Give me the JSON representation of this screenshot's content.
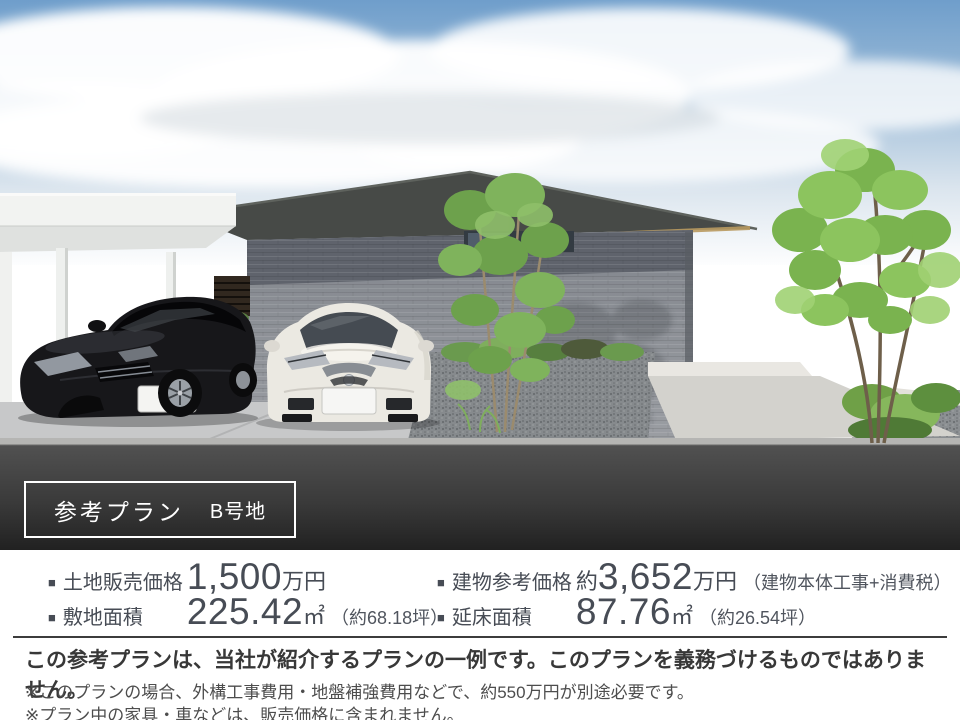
{
  "plan_badge": {
    "plan": "参考プラン",
    "lot": "B号地"
  },
  "specs": {
    "bullet": "■",
    "left": [
      {
        "label": "土地販売価格",
        "prefix": "",
        "value": "1,500",
        "unit": "万円",
        "note": ""
      },
      {
        "label": "敷地面積",
        "prefix": "",
        "value": "225.42",
        "unit": "㎡",
        "note": "（約68.18坪）"
      }
    ],
    "right": [
      {
        "label": "建物参考価格",
        "prefix": "約",
        "value": "3,652",
        "unit": "万円",
        "note": "（建物本体工事+消費税）"
      },
      {
        "label": "延床面積",
        "prefix": "",
        "value": "87.76",
        "unit": "㎡",
        "note": "（約26.54坪）"
      }
    ]
  },
  "disclaimer": {
    "main": "この参考プランは、当社が紹介するプランの一例です。このプランを義務づけるものではありません。",
    "notes": [
      "※このプランの場合、外構工事費用・地盤補強費用などで、約550万円が別途必要です。",
      "※プラン中の家具・車などは、販売価格に含まれません。"
    ]
  },
  "colors": {
    "sky_blue": "#6f9ecb",
    "roof_gray": "#474a47",
    "wall_gray": "#8e9298",
    "road_dark": "#3a3a3a",
    "text_slate": "#474c55",
    "badge_border": "#ffffff",
    "foliage_green": "#7ab34f"
  }
}
